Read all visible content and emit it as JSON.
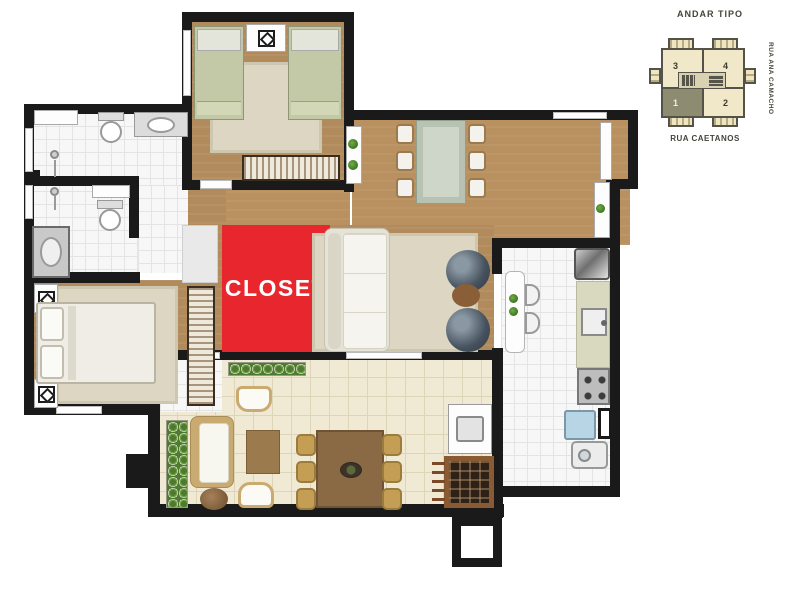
{
  "plan": {
    "closet": {
      "label": "CLOSET",
      "color": "#e8262d"
    }
  },
  "inset": {
    "title": "ANDAR TIPO",
    "streets": {
      "right": "RUA ANA CAMACHO",
      "bottom": "RUA CAETANOS"
    },
    "units": [
      {
        "number": "3",
        "highlighted": false
      },
      {
        "number": "4",
        "highlighted": false
      },
      {
        "number": "1",
        "highlighted": true
      },
      {
        "number": "2",
        "highlighted": false
      }
    ]
  },
  "colors": {
    "wall": "#1a1a1a",
    "wood_floor": "#b28b5d",
    "white_tile": "#f7f7f7",
    "terrace_tile": "#f0e9d4",
    "closet_red": "#e8262d",
    "inset_cream": "#f0e8c8",
    "inset_unit_highlight": "#8e8c70"
  }
}
